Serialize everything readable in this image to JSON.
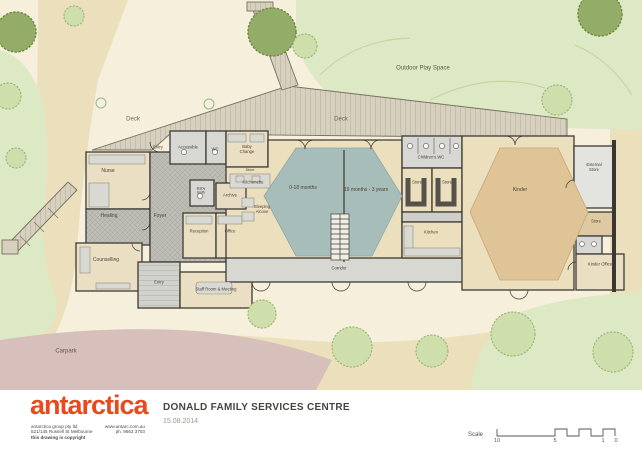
{
  "header": {
    "title": "DONALD FAMILY SERVICES CENTRE",
    "date": "15.08.2014"
  },
  "brand": {
    "logo": "antarctica",
    "address_left1": "antarctica group pty ltd",
    "address_right1": "www.antarc.com.au",
    "address_left2": "521/145 Russell St Melbourne",
    "address_right2": "ph. 9663 3703",
    "copyright": "this drawing is copyright"
  },
  "scale_bar": {
    "label": "Scale",
    "tick_10": "10",
    "tick_5": "5",
    "tick_1": "1",
    "tick_0": "0"
  },
  "site": {
    "deck_left": "Deck",
    "deck_right": "Deck",
    "outdoor_play_space": "Outdoor Play Space",
    "carpark": "Carpark"
  },
  "rooms": {
    "entry_top": "Entry",
    "accessible": "Accessible",
    "wc": "WC",
    "baby_change": "Baby\nChange",
    "nurse": "Nurse",
    "healing": "Healing",
    "counselling": "Counselling",
    "foyer": "Foyer",
    "reception": "Reception",
    "office": "Office",
    "baby_bath": "Baby\nBath",
    "archive": "Archive",
    "store_small": "Store",
    "kitchenette": "Kitchenette",
    "sleeping_alcove": "Sleeping\nAlcove",
    "months_0_18": "0-18 months",
    "months_19_36": "19 months - 3 years",
    "corridor": "Corridor",
    "entry_bottom": "Entry",
    "staff_room": "Staff Room & Meeting",
    "childrens_wc": "Children's WC",
    "store_1": "Store",
    "store_2": "Store",
    "kitchen": "Kitchen",
    "kinder": "Kinder",
    "external_store": "External\nStore",
    "store_3": "Store",
    "kinder_office": "Kinder Office"
  },
  "colors": {
    "accent": "#e8491d",
    "wall": "#3d3a35",
    "deck": "#d7d0bf",
    "play_mat": "#a7bdb9",
    "kinder_mat": "#dec496",
    "green": "#dde9c5",
    "carpark": "#d7bfbc",
    "path": "#ecdfbc"
  }
}
